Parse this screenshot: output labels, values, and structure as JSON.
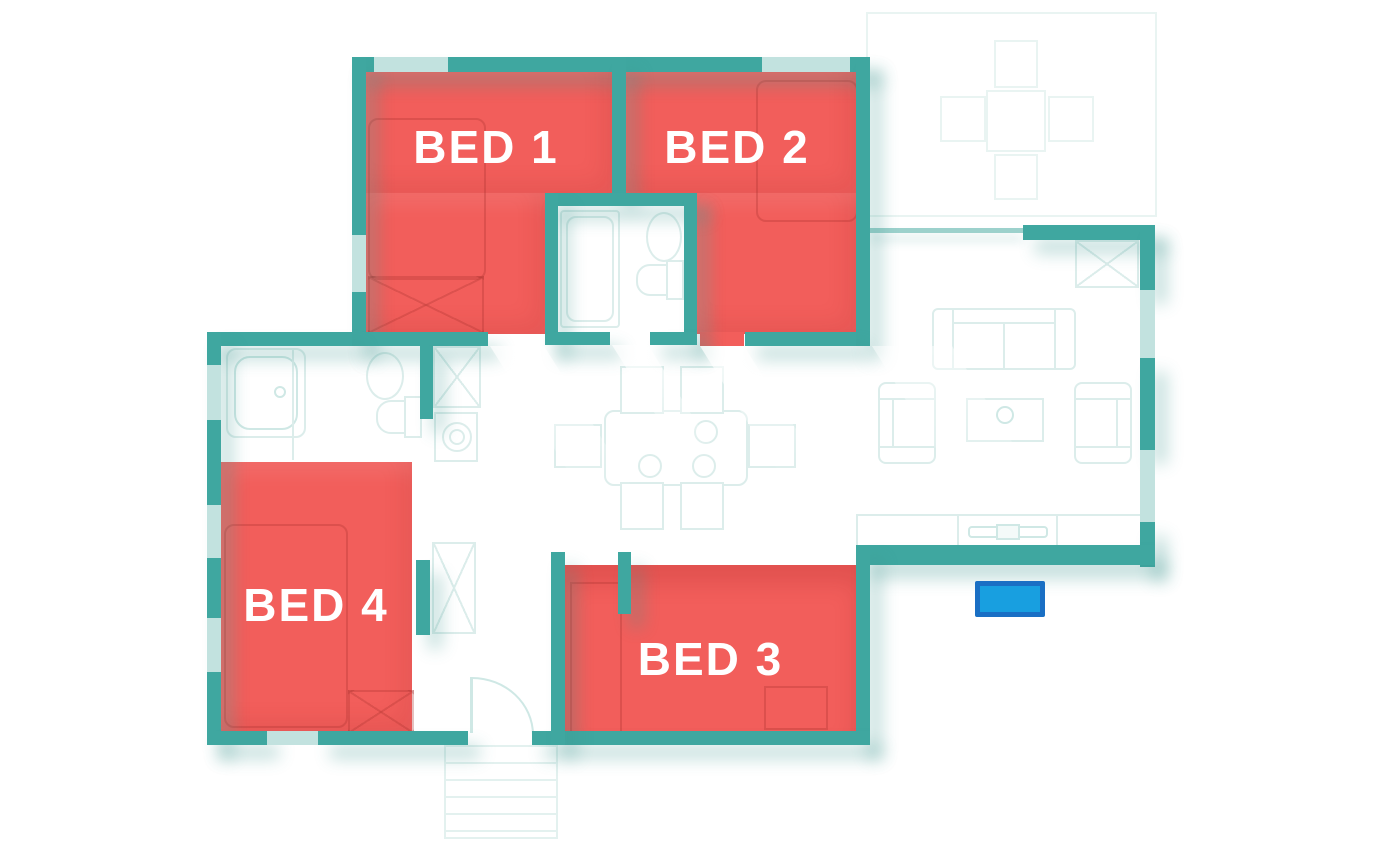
{
  "floorplan": {
    "rooms": [
      {
        "id": "bed-1",
        "label": "BED 1",
        "highlighted": true
      },
      {
        "id": "bed-2",
        "label": "BED 2",
        "highlighted": true
      },
      {
        "id": "bed-3",
        "label": "BED 3",
        "highlighted": true
      },
      {
        "id": "bed-4",
        "label": "BED 4",
        "highlighted": true
      }
    ],
    "marker": {
      "type": "rectangle"
    },
    "colors": {
      "wall": "#3FA7A0",
      "window": "#C2E2DF",
      "room_highlight": "#F25E5B",
      "room_label": "#FFFFFF",
      "furniture_outline": "#DCEDEB",
      "marker_fill": "#189FE0",
      "marker_border": "#1A6FC4"
    },
    "fixtures": [
      "patio-table",
      "patio-chairs",
      "storage-cabinet",
      "sofa",
      "armchair",
      "coffee-table",
      "tv-sideboard",
      "dining-table",
      "dining-chair",
      "bathtub",
      "shower",
      "toilet",
      "sink",
      "washing-machine",
      "wardrobe",
      "entry-stairs",
      "entry-door"
    ]
  }
}
